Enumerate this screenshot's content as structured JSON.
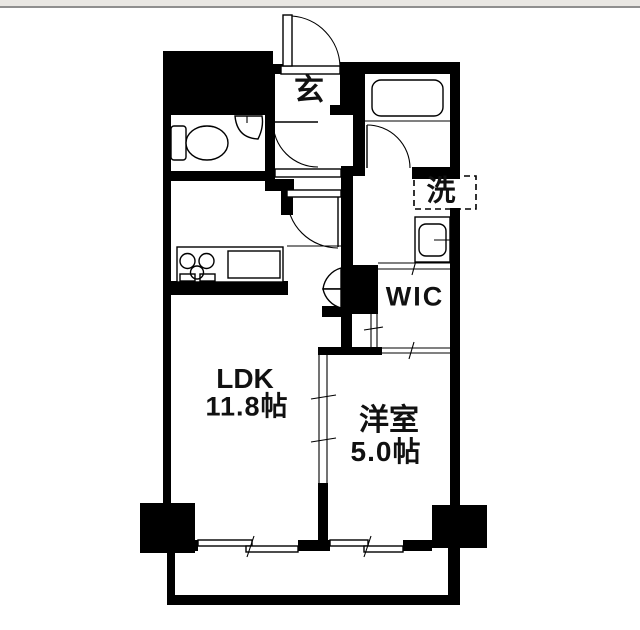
{
  "page": {
    "type": "floor-plan",
    "background": "#ffffff",
    "topbar_color": "#e9e7e3",
    "topbar_line_color": "#8f8f8f",
    "wall_color": "#000000",
    "floor_color": "#ffffff",
    "text_color": "#111111"
  },
  "rooms": {
    "ldk": {
      "name": "LDK",
      "size": "11.8帖"
    },
    "bedroom": {
      "name": "洋室",
      "size": "5.0帖"
    },
    "entrance": {
      "label": "玄"
    },
    "laundry": {
      "label": "洗"
    },
    "wic": {
      "label": "WIC"
    }
  },
  "fixtures": [
    "entrance-swing-door",
    "hall-interior-door",
    "bathtub",
    "bathroom-door",
    "toilet",
    "corner-hand-basin",
    "washer-space",
    "washbasin",
    "kitchen-stove",
    "kitchen-sink",
    "bifold-door",
    "sliding-partition",
    "sliding-window-ldk",
    "sliding-window-bedroom",
    "balcony-rail",
    "pillar"
  ]
}
